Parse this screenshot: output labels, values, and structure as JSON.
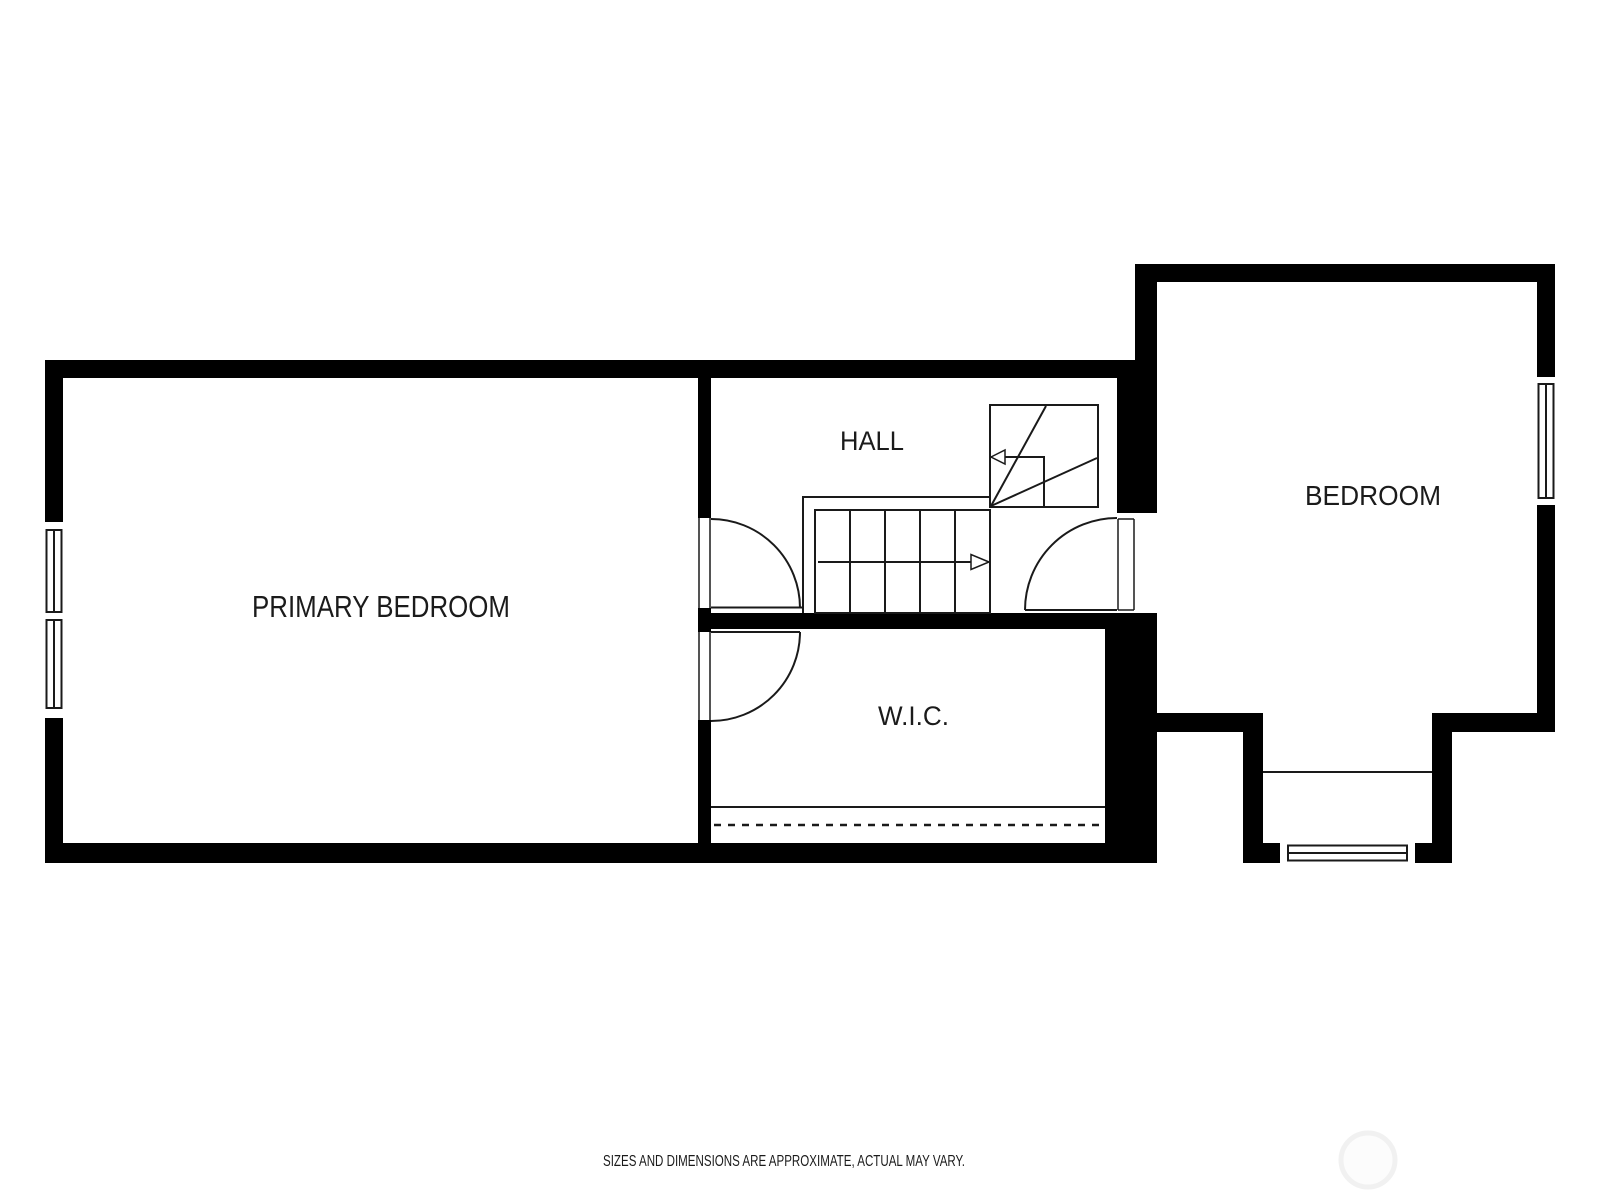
{
  "rooms": {
    "primary_bedroom": {
      "label": "PRIMARY BEDROOM"
    },
    "hall": {
      "label": "HALL"
    },
    "wic": {
      "label": "W.I.C."
    },
    "bedroom": {
      "label": "BEDROOM"
    }
  },
  "footer": {
    "disclaimer": "SIZES AND DIMENSIONS ARE APPROXIMATE, ACTUAL MAY VARY."
  },
  "colors": {
    "wall": "#000000",
    "line": "#1a1a1a",
    "text": "#1b1b1b",
    "background": "#ffffff",
    "watermark_stroke": "#f1f1f1"
  }
}
